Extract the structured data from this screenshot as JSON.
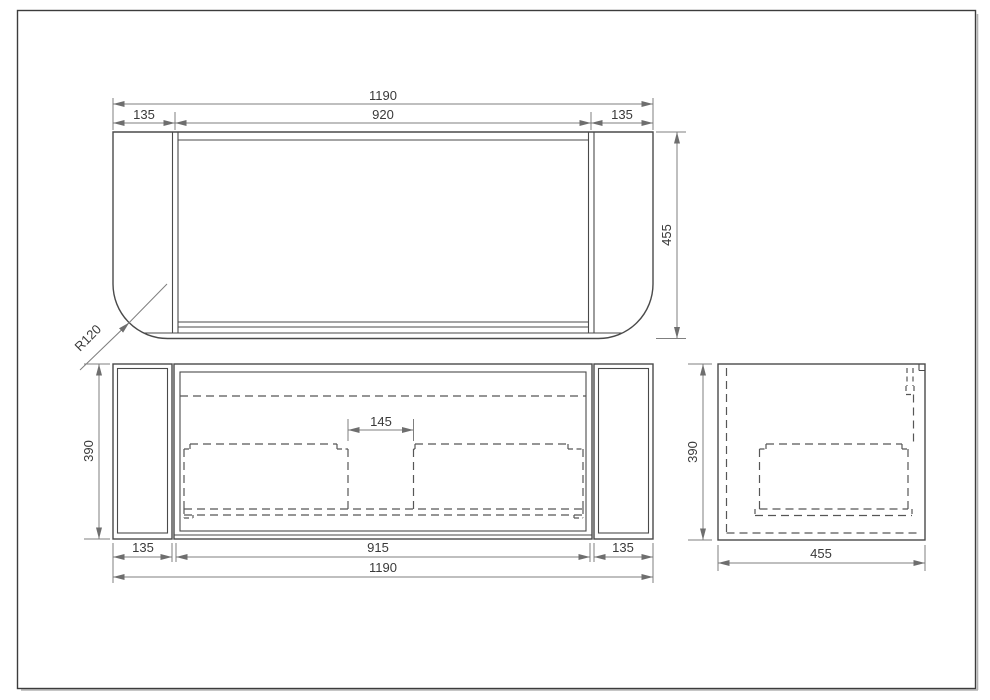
{
  "page": {
    "background": "#ffffff",
    "frame_color": "#3c3c3c"
  },
  "colors": {
    "geometry_line": "#4a4a4a",
    "hidden_line": "#565656",
    "dimension_line": "#7f7f7f",
    "text": "#3a3a3a"
  },
  "views": {
    "top": {
      "label": "top view",
      "dims": {
        "overall_width": "1190",
        "carcass_width": "920",
        "left_panel_width": "135",
        "right_panel_width": "135",
        "depth": "455",
        "corner_radius": "R120"
      }
    },
    "front": {
      "label": "front view",
      "dims": {
        "height": "390",
        "drawer_gap": "145",
        "left_panel_width": "135",
        "opening_width": "915",
        "right_panel_width": "135",
        "overall_width": "1190"
      }
    },
    "side": {
      "label": "side view",
      "dims": {
        "height": "390",
        "depth": "455"
      }
    }
  }
}
